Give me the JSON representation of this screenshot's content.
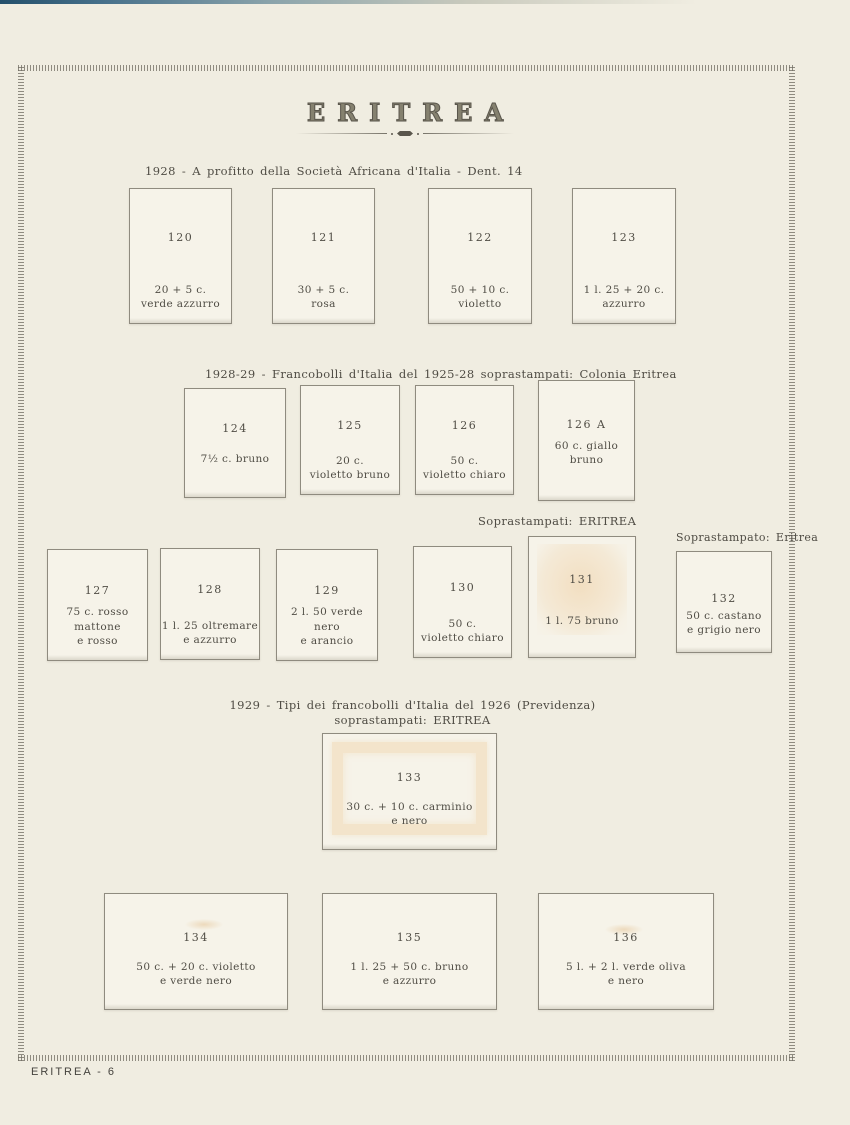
{
  "page": {
    "title": "ERITREA",
    "footer": "ERITREA - 6"
  },
  "headings": {
    "s1": "1928 - A profitto della Società Africana d'Italia - Dent. 14",
    "s2": "1928-29 - Francobolli d'Italia del 1925-28 soprastampati: Colonia Eritrea",
    "s3_left": "Soprastampati: ERITREA",
    "s3_right": "Soprastampato: Eritrea",
    "s4_line1": "1929 - Tipi dei francobolli d'Italia del 1926 (Previdenza)",
    "s4_line2": "soprastampati: ERITREA"
  },
  "stamps": {
    "s120": {
      "number": "120",
      "caption": "20 + 5 c.\nverde azzurro"
    },
    "s121": {
      "number": "121",
      "caption": "30 + 5 c.\nrosa"
    },
    "s122": {
      "number": "122",
      "caption": "50 + 10 c.\nvioletto"
    },
    "s123": {
      "number": "123",
      "caption": "1 l. 25 + 20 c.\nazzurro"
    },
    "s124": {
      "number": "124",
      "caption": "7½ c. bruno"
    },
    "s125": {
      "number": "125",
      "caption": "20 c.\nvioletto bruno"
    },
    "s126": {
      "number": "126",
      "caption": "50 c.\nvioletto chiaro"
    },
    "s126a": {
      "number": "126 A",
      "caption": "60 c. giallo bruno"
    },
    "s127": {
      "number": "127",
      "caption": "75 c. rosso mattone\ne rosso"
    },
    "s128": {
      "number": "128",
      "caption": "1 l. 25 oltremare\ne azzurro"
    },
    "s129": {
      "number": "129",
      "caption": "2 l. 50 verde nero\ne arancio"
    },
    "s130": {
      "number": "130",
      "caption": "50 c.\nvioletto chiaro"
    },
    "s131": {
      "number": "131",
      "caption": "1 l. 75 bruno"
    },
    "s132": {
      "number": "132",
      "caption": "50 c. castano\ne grigio nero"
    },
    "s133": {
      "number": "133",
      "caption": "30 c. + 10 c. carminio\ne nero"
    },
    "s134": {
      "number": "134",
      "caption": "50 c. + 20 c. violetto\ne verde nero"
    },
    "s135": {
      "number": "135",
      "caption": "1 l. 25 + 50 c. bruno\ne azzurro"
    },
    "s136": {
      "number": "136",
      "caption": "5 l. + 2 l. verde oliva\ne nero"
    }
  },
  "colors": {
    "page_bg": "#f0ede1",
    "mount_bg": "#f6f3e9",
    "mount_border": "#8f8b7f",
    "ink": "#4f4c44",
    "toning": "#eebe7d",
    "scan_edge_blue": "#24506b"
  }
}
